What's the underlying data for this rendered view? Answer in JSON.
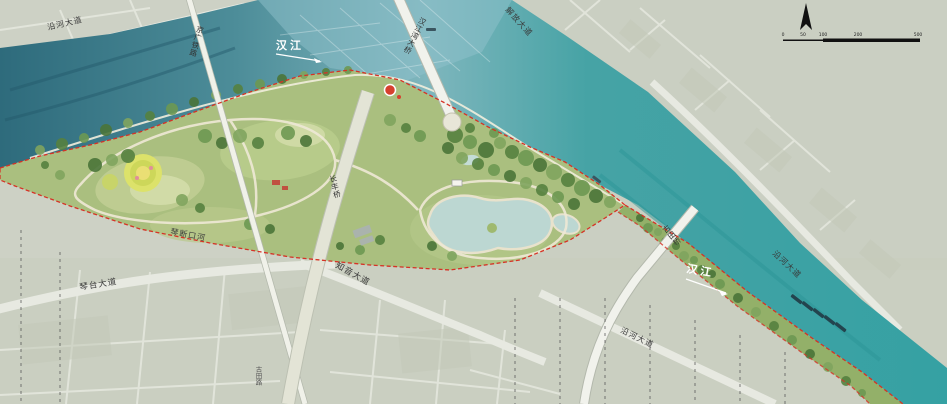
{
  "labels": {
    "river_left": "汉江",
    "river_right": "汉江",
    "bridge_hanjiangwan": "汉江湾大桥",
    "bridge_changfeng": "长丰桥",
    "bridge_gutian": "古田桥",
    "railway": "京广铁路",
    "road_yanhe_nw": "沿河大道",
    "road_jiefang": "解放大道",
    "road_yanhe_ne": "沿河大道",
    "road_yanhe_se": "沿河大道",
    "road_qintai": "琴台大道",
    "road_zhiyin": "知音大道",
    "road_gutian": "古田路",
    "canal_qinduankou": "琴断口河"
  },
  "scalebar": {
    "ticks": [
      "0",
      "50",
      "100",
      "200",
      "500"
    ]
  },
  "icons": {
    "north_arrow": "north-arrow",
    "landmark": "red-landmark-marker"
  },
  "colors": {
    "water_dark": "#2e6b7c",
    "water_teal": "#35a1a3",
    "park_green": "#aabf7f",
    "tree_green": "#55813f",
    "boundary_red": "#d63226",
    "city_grey": "#cdd1c5",
    "lake_blue": "#bcd7d2",
    "road_pale": "#eceee6",
    "sand": "#d9d2b2"
  }
}
